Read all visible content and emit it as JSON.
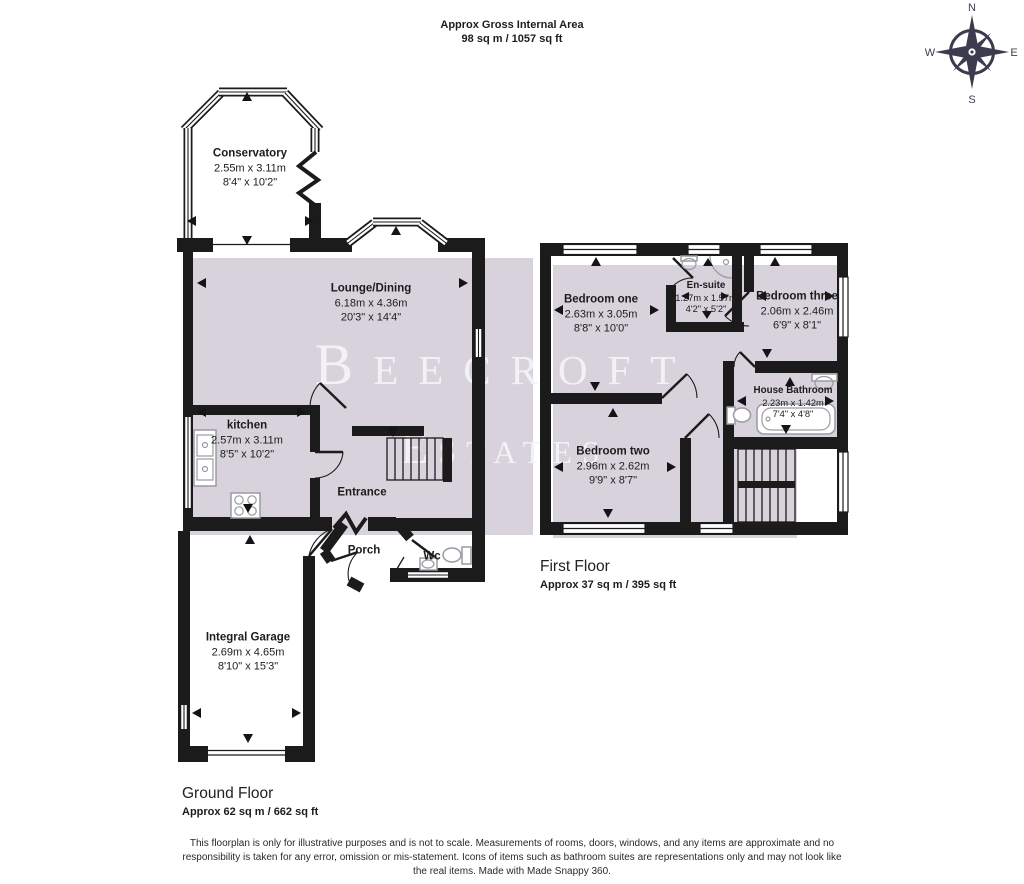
{
  "header": {
    "title": "Approx Gross Internal Area",
    "area": "98 sq m / 1057 sq ft"
  },
  "compass": {
    "north": "N",
    "east": "E",
    "south": "S",
    "west": "W"
  },
  "watermark": {
    "line1": "Beecroft",
    "line2": "Estates"
  },
  "ground_floor": {
    "label": "Ground Floor",
    "area": "Approx 62 sq m / 662 sq ft",
    "rooms": {
      "conservatory": {
        "name": "Conservatory",
        "metric": "2.55m x 3.11m",
        "imperial": "8'4\" x 10'2\""
      },
      "lounge": {
        "name": "Lounge/Dining",
        "metric": "6.18m x 4.36m",
        "imperial": "20'3\" x 14'4\""
      },
      "kitchen": {
        "name": "kitchen",
        "metric": "2.57m x 3.11m",
        "imperial": "8'5\" x 10'2\""
      },
      "entrance": {
        "name": "Entrance"
      },
      "porch": {
        "name": "Porch"
      },
      "wc": {
        "name": "Wc"
      },
      "garage": {
        "name": "Integral Garage",
        "metric": "2.69m x 4.65m",
        "imperial": "8'10\" x 15'3\""
      }
    }
  },
  "first_floor": {
    "label": "First Floor",
    "area": "Approx 37 sq m / 395 sq ft",
    "rooms": {
      "bedroom_one": {
        "name": "Bedroom one",
        "metric": "2.63m x 3.05m",
        "imperial": "8'8\" x 10'0\""
      },
      "en_suite": {
        "name": "En-suite",
        "metric": "1.27m x 1.57m",
        "imperial": "4'2\" x 5'2\""
      },
      "bedroom_three": {
        "name": "Bedroom three",
        "metric": "2.06m x 2.46m",
        "imperial": "6'9\" x 8'1\""
      },
      "house_bathroom": {
        "name": "House Bathroom",
        "metric": "2.23m x 1.42m",
        "imperial": "7'4\" x 4'8\""
      },
      "bedroom_two": {
        "name": "Bedroom two",
        "metric": "2.96m x 2.62m",
        "imperial": "9'9\" x 8'7\""
      }
    }
  },
  "footer": {
    "disclaimer": "This floorplan is only for illustrative purposes and is not to scale. Measurements of rooms, doors, windows, and any items are approximate and no responsibility is taken for any error, omission or mis-statement. Icons of items such as bathroom suites are representations only and may not look like the real items. Made with Made Snappy 360."
  },
  "colors": {
    "wall": "#1b1b1b",
    "room_fill": "#d7d2db",
    "watermark": "#f3f1f6"
  }
}
